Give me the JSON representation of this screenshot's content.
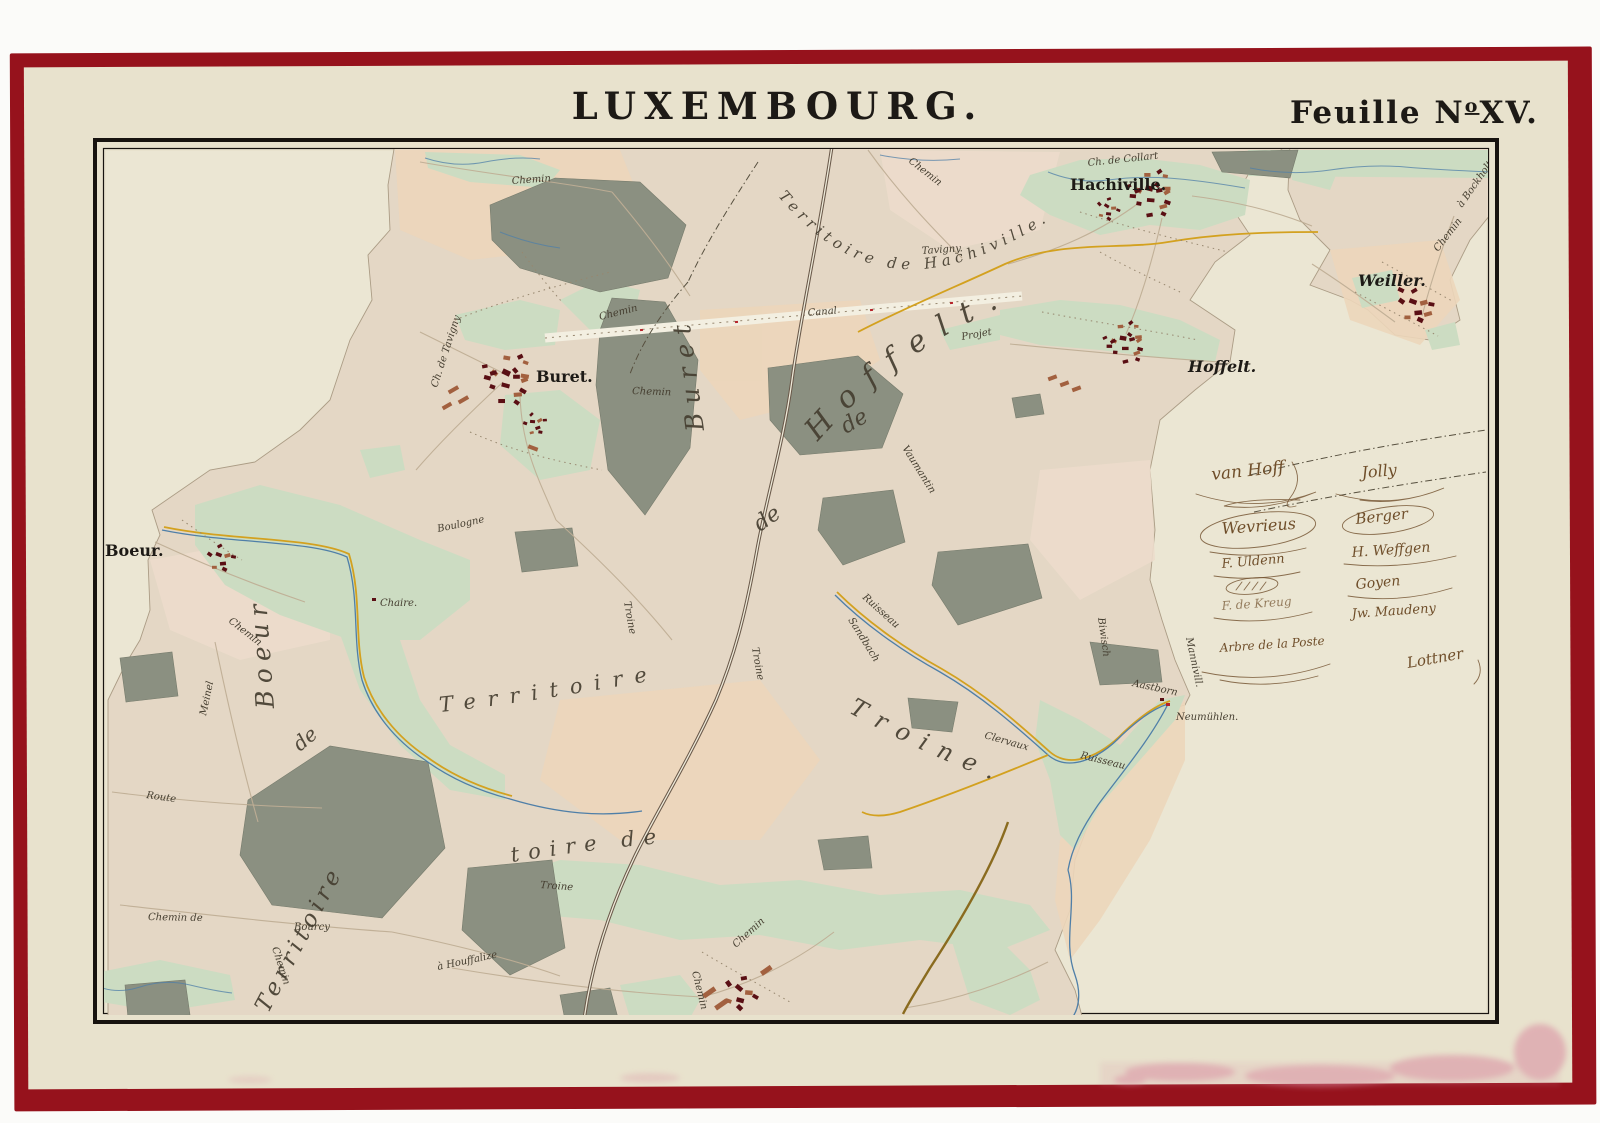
{
  "palette": {
    "mat_red": "#96121c",
    "paper": "#e8e2cd",
    "paper_light": "#eeead9",
    "frame_black": "#17130f",
    "field": "#e4d7c5",
    "field_peach": "#ecd6ba",
    "field_pink": "#ecdccb",
    "terr_edge": "#ab9c85",
    "meadow_green": "#ccdcc2",
    "wood_gray": "#8b9081",
    "wood_edge": "#767b6c",
    "building_dark": "#5a0f14",
    "building_light": "#a2603f",
    "accent_red": "#b5232a",
    "road_thin": "#bfae95",
    "road_dark": "#6a594a",
    "road_yellow": "#d3a11f",
    "road_olive": "#8a6b1f",
    "canal_white": "#f3efe1",
    "stream_blue": "#4f7fa8",
    "boundary_ink": "#57503f",
    "dot_ink": "#97876f",
    "ink": "#1d1a16",
    "label_ink": "#453e30",
    "sig_ink": "#6f4e2a",
    "stain_pink": "#d98ba0"
  },
  "header": {
    "title": "LUXEMBOURG.",
    "sheet_label": "Feuille N",
    "sheet_sup": "o",
    "sheet_num": "XV."
  },
  "villages": {
    "hachiville": "Hachiville.",
    "weiller": "Weiller.",
    "hoffelt": "Hoffelt.",
    "buret": "Buret.",
    "boeur": "Boeur.",
    "neumuhlen": "Neumühlen.",
    "chaire": "Chaire."
  },
  "territories": {
    "hachiville": "Territoire de Hachiville.",
    "hoffelt": "Hoffelt.",
    "buret": "Buret",
    "boeur": "Boeur",
    "bottom_left": "Territoire",
    "middle": "Territoire",
    "toire_de": "toire de",
    "troine": "Troine.",
    "de_a": "de",
    "de_b": "de",
    "de_c": "de"
  },
  "roads": {
    "chemin_top": "Chemin",
    "chemin_ne": "Chemin",
    "chemin_buret_nw": "Chemin",
    "chemin_buret_s": "Chemin",
    "chemin_boeur": "Chemin",
    "chemin_bl": "Chemin   de",
    "chemin_bl2": "Chemin",
    "chemin_bottom": "Chemin",
    "chemin_bottom2": "Chemin",
    "chemin_weiller": "Chemin",
    "bockholtein": "à Bockholtein",
    "ch_collart": "Ch. de Collart",
    "ch_tavigny": "Ch. de Tavigny",
    "tavigny": "Tavigny.",
    "canal": "Canal",
    "projet": "Projet",
    "route": "Route",
    "meinel": "Meinel",
    "boulogne": "Boulogne",
    "bourcy": "Bourcy",
    "houffalize": "à Houffalize",
    "troine_rd1": "Troine",
    "troine_rd2": "Troine",
    "troine_rd3": "Troine",
    "vaumantin": "Vaumantin",
    "ruisseau1": "Ruisseau",
    "ruisseau2": "Ruisseau",
    "clervaux": "Clervaux",
    "biwisch": "Biwisch",
    "aastborn": "Aastborn",
    "manniville": "Mannivill.",
    "sandbach": "Sandbach"
  },
  "signatures": {
    "left": [
      "van Hoff",
      "Wevrieus",
      "F. Uldenn",
      "F. de Kreug"
    ],
    "right": [
      "Jolly",
      "Berger",
      "H. Weffgen",
      "Goyen",
      "Jw. Maudeny"
    ],
    "note": "Arbre de la Poste",
    "right_bottom": "Lottner"
  }
}
